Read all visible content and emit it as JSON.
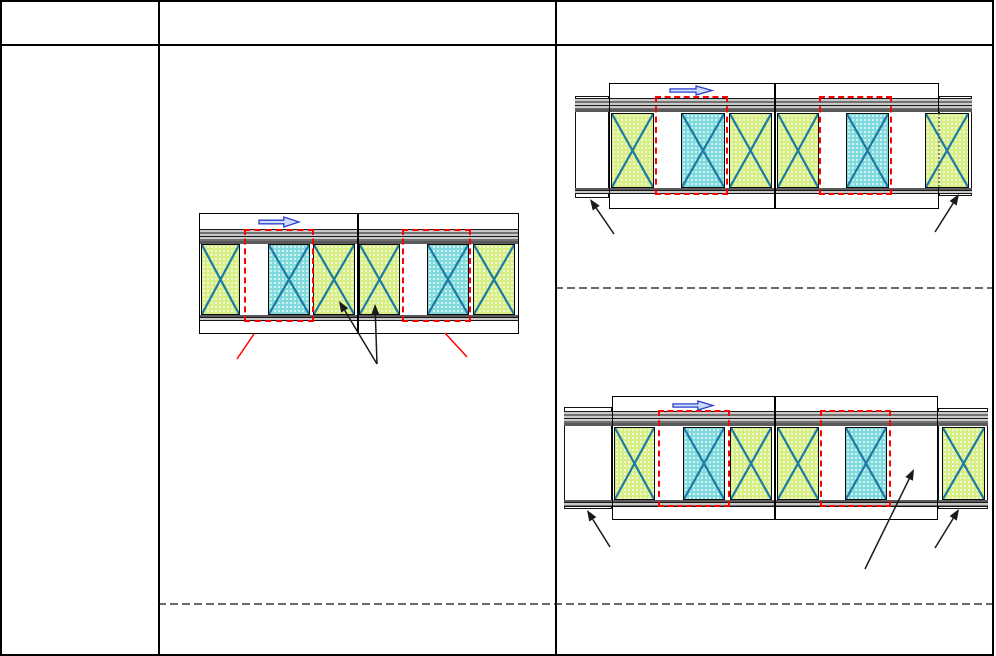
{
  "sheet": {
    "width": 994,
    "height": 656,
    "header_row_y": 42,
    "column_borders_x": [
      156,
      553
    ],
    "dashed_separators": [
      {
        "x1": 553,
        "y": 286,
        "x2": 992
      },
      {
        "x1": 156,
        "y": 602,
        "x2": 992
      }
    ]
  },
  "colors": {
    "panel_green": "#d7ee85",
    "panel_cyan": "#7fd9dd",
    "cross_stroke": "#1d7ba3",
    "rail_fill": "#c9c9c9",
    "rail_line": "#1a1a1a",
    "rail_edge_dark": "#5a5a5a",
    "highlight_red": "#ff0000",
    "arrow_black": "#1a1a1a",
    "blue_arrow_fill": "#cdddf7",
    "blue_arrow_stroke": "#2e3ed0",
    "table_border": "#000000",
    "background": "#ffffff"
  },
  "diagrams": [
    {
      "id": "middle-plan",
      "box": {
        "x": 197,
        "y": 211,
        "w": 320,
        "h": 121
      },
      "divider_x": 355,
      "rail_top": {
        "x": 197,
        "y": 227,
        "w": 320,
        "h": 15
      },
      "rail_bottom": {
        "x": 197,
        "y": 313,
        "w": 320,
        "h": 6
      },
      "tabs": [],
      "panel_y": 242,
      "panel_h": 71,
      "panels": [
        {
          "type": "green",
          "x": 199,
          "w": 39
        },
        {
          "type": "cyan",
          "x": 266,
          "w": 42
        },
        {
          "type": "green",
          "x": 311,
          "w": 42
        },
        {
          "type": "green",
          "x": 357,
          "w": 41
        },
        {
          "type": "cyan",
          "x": 425,
          "w": 42
        },
        {
          "type": "green",
          "x": 471,
          "w": 42
        }
      ],
      "red_boxes": [
        {
          "x": 242,
          "y": 227,
          "w": 70,
          "h": 93
        },
        {
          "x": 400,
          "y": 227,
          "w": 69,
          "h": 93
        }
      ],
      "blue_arrow": {
        "x": 257,
        "y": 215,
        "w": 40,
        "h": 10
      },
      "black_arrows": [
        {
          "x1": 375,
          "y1": 362,
          "x2": 337,
          "y2": 299
        },
        {
          "x1": 375,
          "y1": 362,
          "x2": 373,
          "y2": 302
        }
      ],
      "red_lines": [
        {
          "x1": 252,
          "y1": 332,
          "x2": 235,
          "y2": 357
        },
        {
          "x1": 443,
          "y1": 331,
          "x2": 465,
          "y2": 355
        }
      ],
      "dotted_lines": []
    },
    {
      "id": "right-plan-top",
      "box": {
        "x": 607,
        "y": 81,
        "w": 330,
        "h": 126
      },
      "divider_x": 772,
      "rail_top": {
        "x": 573,
        "y": 96,
        "w": 397,
        "h": 14
      },
      "rail_bottom": {
        "x": 573,
        "y": 186,
        "w": 397,
        "h": 6
      },
      "tabs": [
        {
          "x": 573,
          "y": 94,
          "w": 34,
          "h": 102
        },
        {
          "x": 937,
          "y": 94,
          "w": 33,
          "h": 100
        }
      ],
      "panel_y": 111,
      "panel_h": 75,
      "panels": [
        {
          "type": "green",
          "x": 609,
          "w": 43
        },
        {
          "type": "cyan",
          "x": 679,
          "w": 44
        },
        {
          "type": "green",
          "x": 727,
          "w": 43
        },
        {
          "type": "green",
          "x": 775,
          "w": 42
        },
        {
          "type": "cyan",
          "x": 844,
          "w": 43
        },
        {
          "type": "green",
          "x": 923,
          "w": 44
        }
      ],
      "red_boxes": [
        {
          "x": 653,
          "y": 94,
          "w": 73,
          "h": 99
        },
        {
          "x": 817,
          "y": 94,
          "w": 73,
          "h": 99
        }
      ],
      "blue_arrow": {
        "x": 668,
        "y": 84,
        "w": 42,
        "h": 9
      },
      "black_arrows": [
        {
          "x1": 612,
          "y1": 232,
          "x2": 588,
          "y2": 197
        },
        {
          "x1": 933,
          "y1": 230,
          "x2": 957,
          "y2": 192
        }
      ],
      "red_lines": [],
      "dotted_lines": [
        {
          "x": 937,
          "y1": 111,
          "y2": 186
        }
      ]
    },
    {
      "id": "right-plan-bottom",
      "box": {
        "x": 610,
        "y": 394,
        "w": 326,
        "h": 124
      },
      "divider_x": 772,
      "rail_top": {
        "x": 562,
        "y": 409,
        "w": 424,
        "h": 15
      },
      "rail_bottom": {
        "x": 562,
        "y": 498,
        "w": 424,
        "h": 7
      },
      "tabs": [
        {
          "x": 562,
          "y": 405,
          "w": 48,
          "h": 102
        },
        {
          "x": 936,
          "y": 406,
          "w": 50,
          "h": 101
        }
      ],
      "panel_y": 425,
      "panel_h": 73,
      "panels": [
        {
          "type": "green",
          "x": 612,
          "w": 41
        },
        {
          "type": "cyan",
          "x": 681,
          "w": 42
        },
        {
          "type": "green",
          "x": 728,
          "w": 42
        },
        {
          "type": "green",
          "x": 775,
          "w": 42
        },
        {
          "type": "cyan",
          "x": 843,
          "w": 42
        },
        {
          "type": "green",
          "x": 940,
          "w": 43
        }
      ],
      "red_boxes": [
        {
          "x": 656,
          "y": 408,
          "w": 72,
          "h": 97
        },
        {
          "x": 818,
          "y": 408,
          "w": 71,
          "h": 97
        }
      ],
      "blue_arrow": {
        "x": 671,
        "y": 399,
        "w": 40,
        "h": 9
      },
      "black_arrows": [
        {
          "x1": 608,
          "y1": 545,
          "x2": 585,
          "y2": 508
        },
        {
          "x1": 933,
          "y1": 546,
          "x2": 957,
          "y2": 507
        },
        {
          "x1": 863,
          "y1": 567,
          "x2": 912,
          "y2": 467
        }
      ],
      "red_lines": [],
      "dotted_lines": []
    }
  ]
}
